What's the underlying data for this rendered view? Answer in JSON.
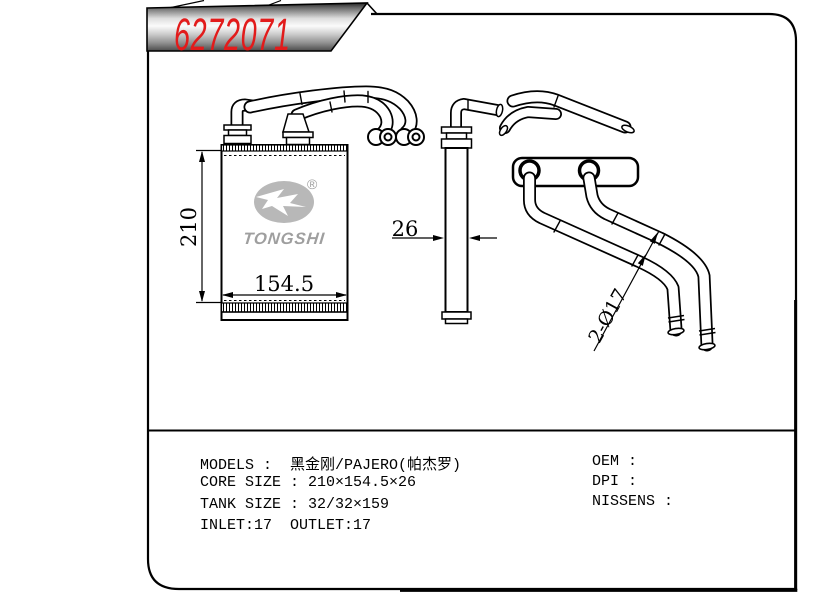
{
  "banner": {
    "part_number": "6272071"
  },
  "logo": {
    "text": "TONGSHI",
    "registered_mark": "®"
  },
  "drawing": {
    "dim_height": "210",
    "dim_width": "154.5",
    "dim_depth": "26",
    "dim_pipes": "2-Ø17"
  },
  "specs": {
    "models": "MODELS :  黑金刚/PAJERO(帕杰罗)",
    "core_size": "CORE SIZE : 210×154.5×26",
    "tank_size": "TANK SIZE : 32/32×159",
    "inlet_outlet": "INLET:17  OUTLET:17",
    "oem": "OEM :",
    "dpi": "DPI :",
    "nissens": "NISSENS :"
  },
  "colors": {
    "part_number_red": "#e21b1b",
    "logo_gray": "#9f9f9f",
    "logo_ellipse_gray": "#b8b8b8",
    "line_black": "#000000",
    "background": "#ffffff"
  }
}
